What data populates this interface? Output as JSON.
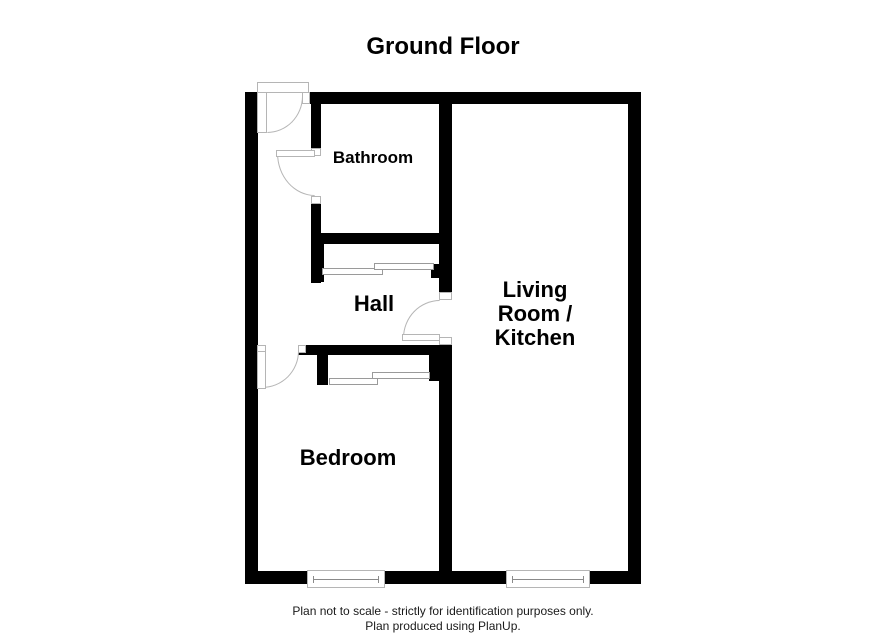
{
  "title": "Ground Floor",
  "rooms": {
    "bathroom": {
      "label": "Bathroom"
    },
    "hall": {
      "label": "Hall"
    },
    "living": {
      "label": "Living Room / Kitchen",
      "label_lines": [
        "Living",
        "Room /",
        "Kitchen"
      ]
    },
    "bedroom": {
      "label": "Bedroom"
    }
  },
  "footer": {
    "line1": "Plan not to scale - strictly for identification purposes only.",
    "line2": "Plan produced using PlanUp."
  },
  "colors": {
    "wall": "#000000",
    "background": "#ffffff",
    "door_line": "#b5b5b5",
    "text": "#000000"
  }
}
